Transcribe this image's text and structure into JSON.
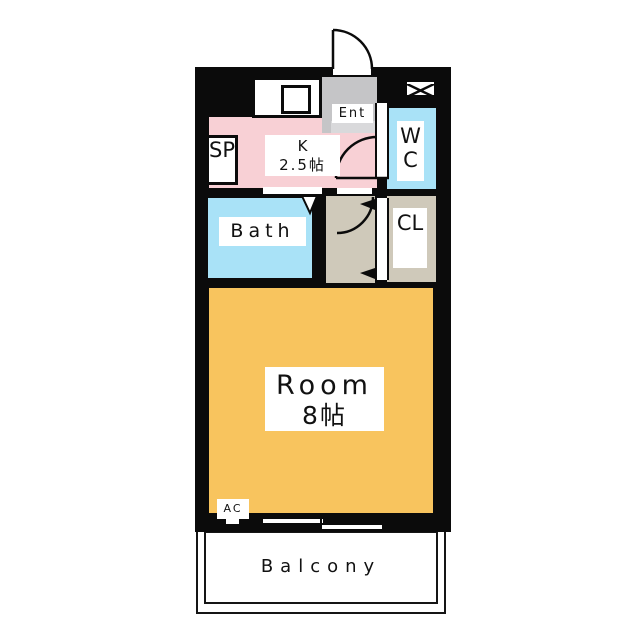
{
  "floorplan": {
    "type": "apartment-floor-plan",
    "wall_color": "#0b0b0b",
    "rooms": {
      "kitchen": {
        "label": "K",
        "size": "2.5帖",
        "floor_color": "#F8D0D5"
      },
      "entrance": {
        "label": "Ent",
        "floor_color": "#C5C5C7",
        "step_color": "#D9D9DB"
      },
      "service_space": {
        "label": "SP"
      },
      "wc": {
        "label": "WC",
        "floor_color": "#A9E2F7"
      },
      "closet": {
        "label": "CL",
        "floor_color": "#CFC9BA"
      },
      "hallway": {
        "floor_color": "#CFC9BA"
      },
      "bath": {
        "label": "Bath",
        "floor_color": "#A9E2F7"
      },
      "main_room": {
        "label": "Room",
        "size": "8帖",
        "floor_color": "#F8C45E"
      },
      "balcony": {
        "label": "Balcony"
      },
      "air_conditioner": {
        "label": "AC"
      }
    }
  }
}
